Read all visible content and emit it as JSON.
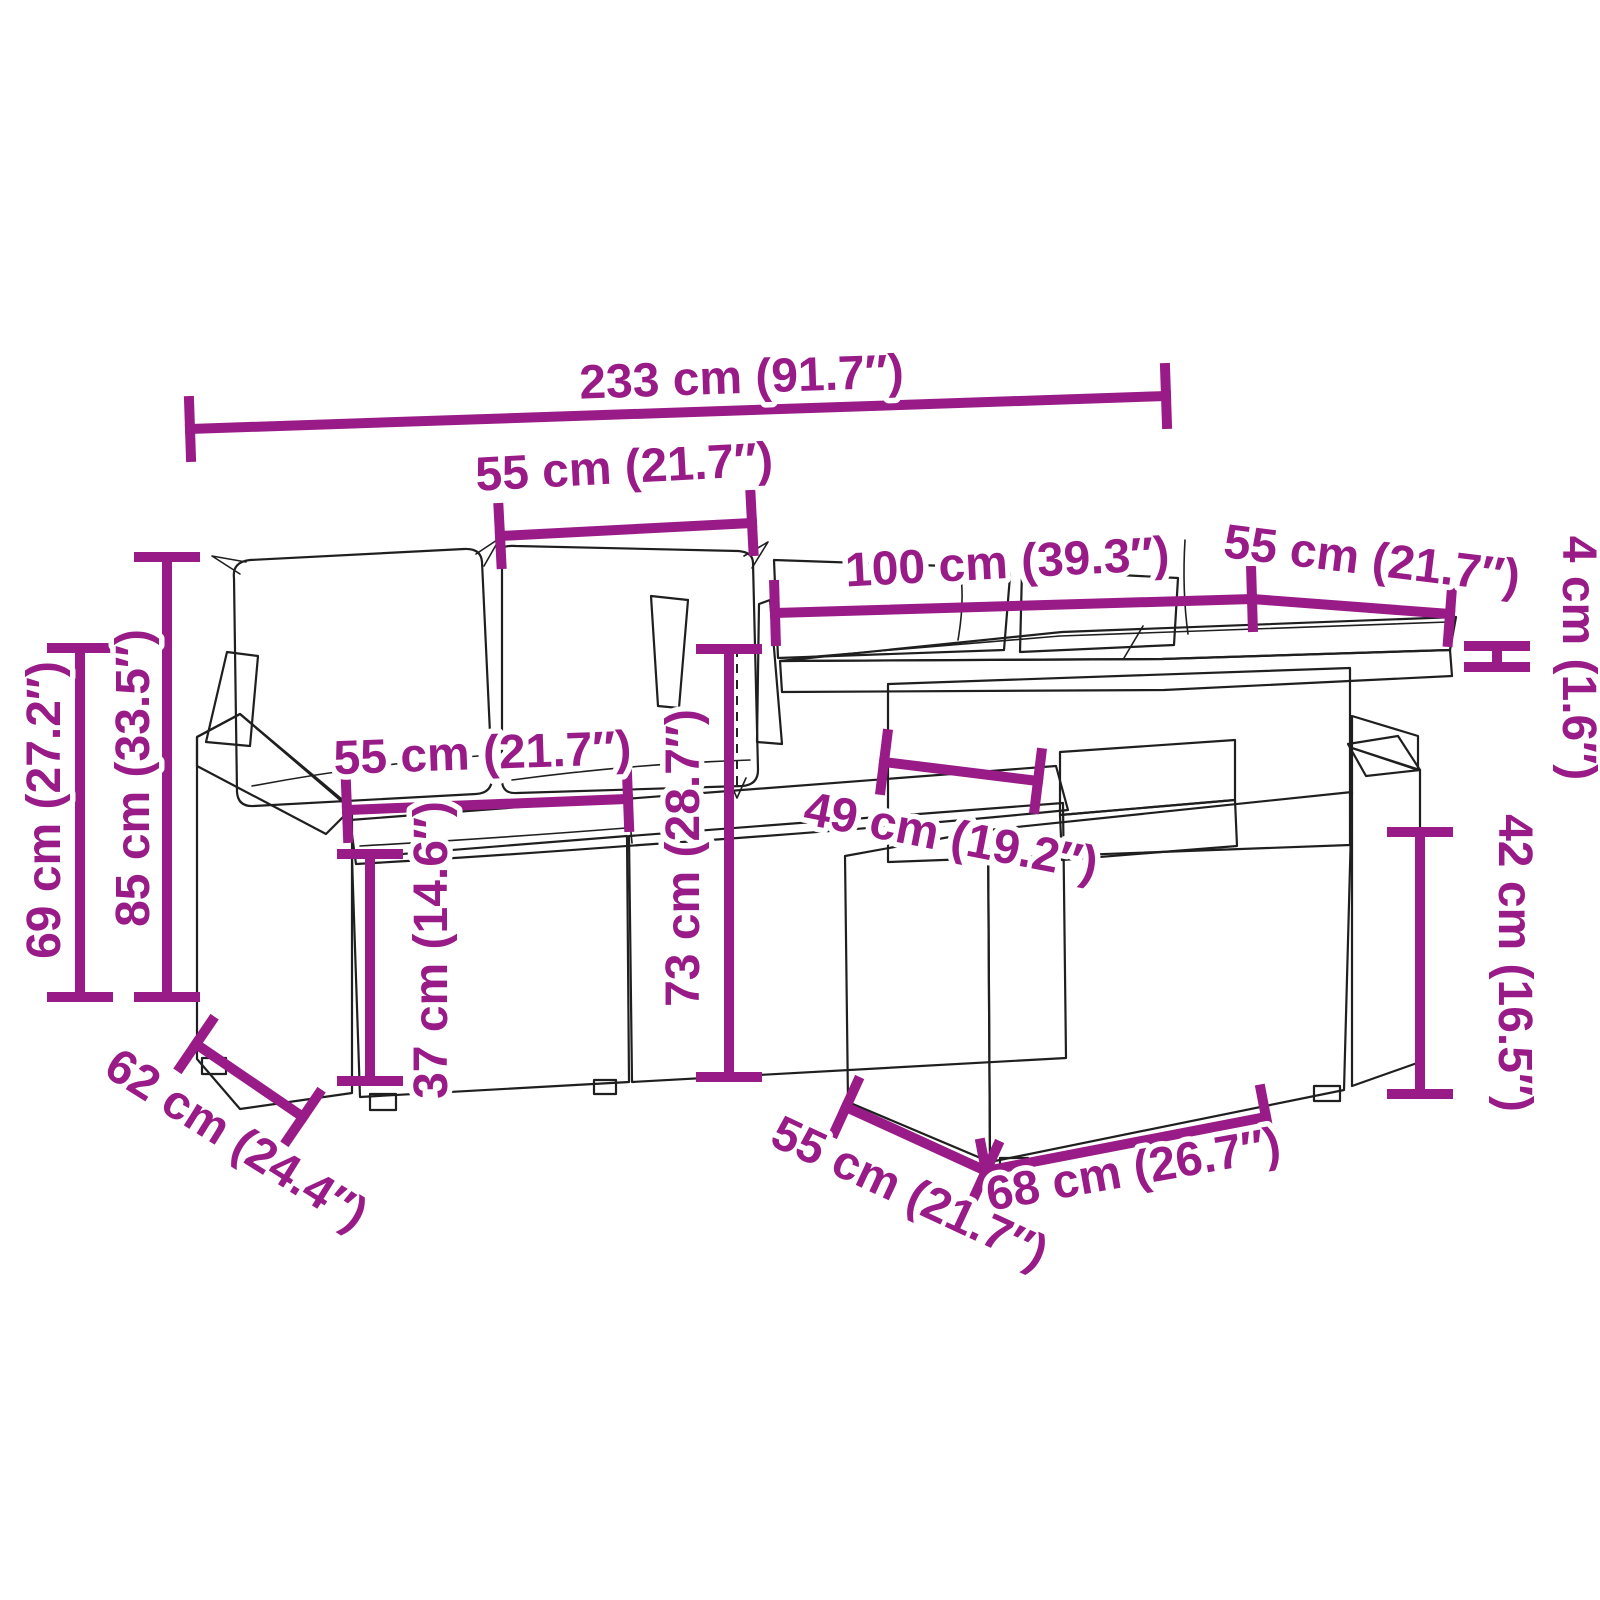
{
  "diagram": {
    "accent_color": "#981b87",
    "line_color": "#1f1f1f",
    "background": "#ffffff",
    "subject": "garden-lounge-set-with-table-dimension-diagram",
    "unit_system": "cm and inches"
  },
  "labels": {
    "total_width": "233 cm (91.7″)",
    "back_cushion_width": "55 cm (21.7″)",
    "table_length": "100 cm (39.3″)",
    "table_depth": "55 cm (21.7″)",
    "tabletop_thickness": "4 cm (1.6″)",
    "armrest_height": "69 cm (27.2″)",
    "total_height": "85 cm (33.5″)",
    "seat_width": "55 cm (21.7″)",
    "seat_height": "37 cm (14.6″)",
    "table_height": "73 cm (28.7″)",
    "table_clearance": "49 cm (19.2″)",
    "side_unit_height": "42 cm (16.5″)",
    "seat_depth": "62 cm (24.4″)",
    "base_depth": "55 cm (21.7″)",
    "base_width": "68 cm (26.7″)"
  }
}
